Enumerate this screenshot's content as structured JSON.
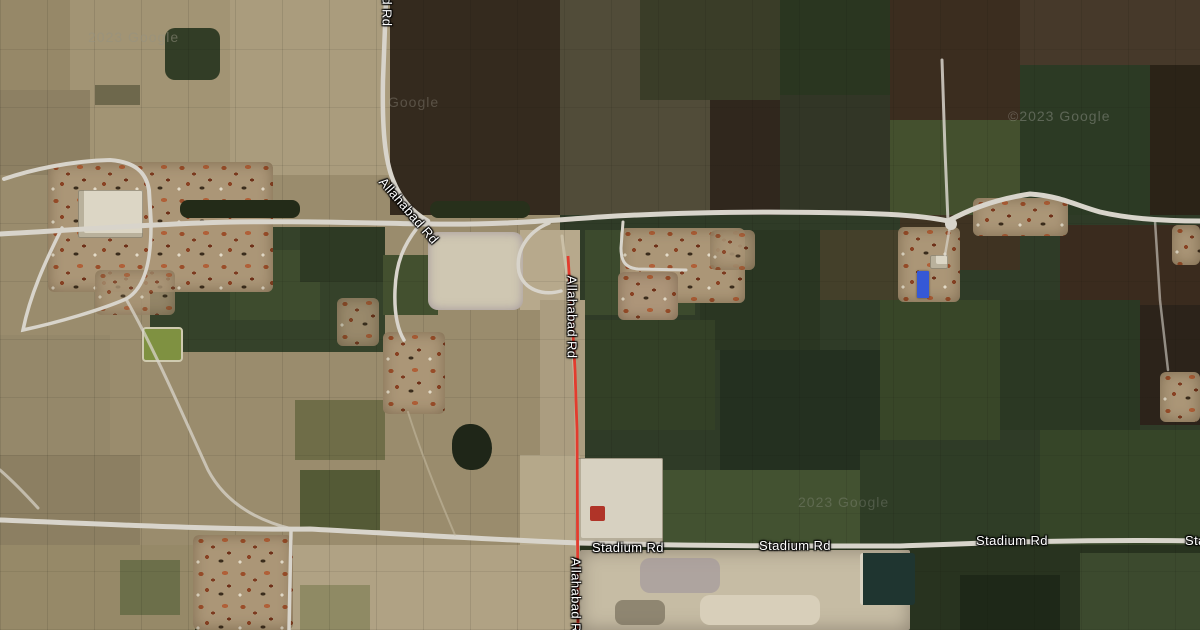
{
  "map": {
    "road_labels": {
      "allahabad_top": "Allahabad Rd",
      "allahabad_curve": "Allahabad Rd",
      "allahabad_mid": "Allahabad Rd",
      "allahabad_bottom": "Allahabad Rd",
      "stadium_1": "Stadium Rd",
      "stadium_2": "Stadium Rd",
      "stadium_3": "Stadium Rd",
      "stadium_4_clipped": "Stadium Rd"
    },
    "watermarks": {
      "w1": "2023 Google",
      "w2": "Google",
      "w3": "©2023 Google",
      "w4": "2023 Google"
    },
    "colors": {
      "road_fill": "#d8d4cb",
      "route_red": "#e23c2e",
      "route_red_dark": "#7e150c",
      "label_text": "#ffffff",
      "blue_roof": "#3558d6",
      "red_roof": "#b03428"
    }
  }
}
